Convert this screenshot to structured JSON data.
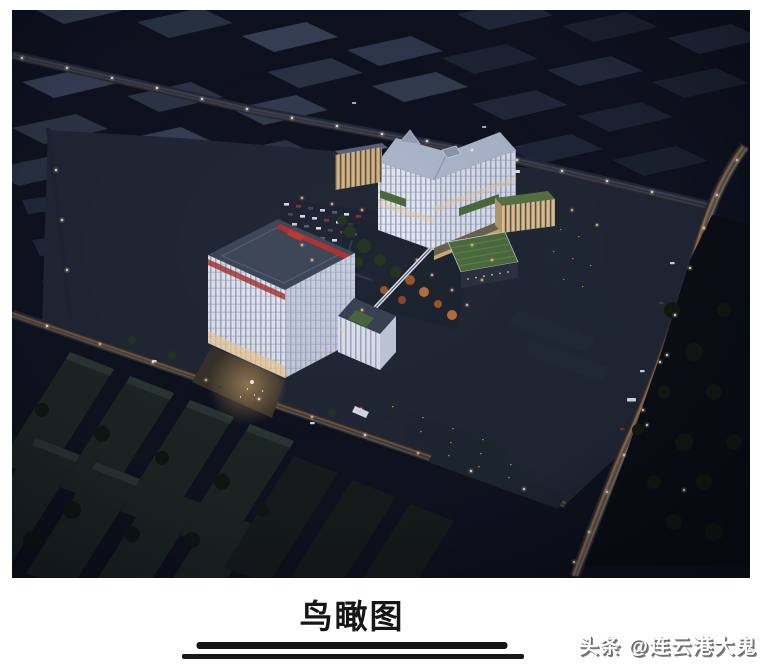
{
  "photo": {
    "alt": "夜景鸟瞰效果图：园区两栋白色亮灯主楼，绿化庭院与停车场，周边厂房、住宅及道路车流光带",
    "palette": {
      "night_base": "#0f1320",
      "warehouse_roof": "#353e52",
      "building_white": "#e6ebf7",
      "warm_window": "#f0c98a",
      "green_roof": "#4c6d3e",
      "red_accent": "#b23230",
      "road_trail_orange": "#d98a3e",
      "lamp_white": "#fff8e6"
    }
  },
  "caption": {
    "title": "鸟瞰图"
  },
  "watermark": {
    "text": "头条 @连云港大鬼"
  }
}
